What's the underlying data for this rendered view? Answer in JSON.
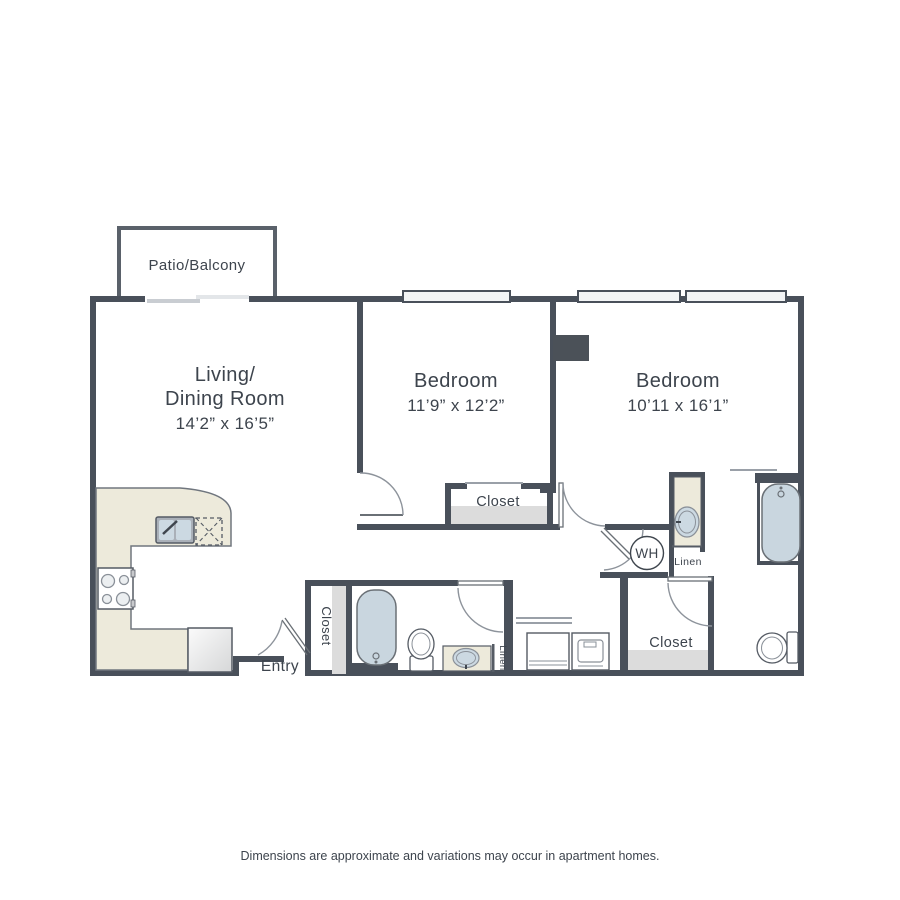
{
  "plan": {
    "patio_label": "Patio/Balcony",
    "living": {
      "name_line1": "Living/",
      "name_line2": "Dining Room",
      "dims": "14’2” x 16’5”"
    },
    "bedroom1": {
      "name": "Bedroom",
      "dims": "11’9” x 12’2”"
    },
    "bedroom2": {
      "name": "Bedroom",
      "dims": "10’11 x 16’1”"
    },
    "closet_bedroom1": "Closet",
    "closet_entry": "Closet",
    "closet_hall": "Closet",
    "linen_bath1": "Linen",
    "linen_bath2": "Linen",
    "water_heater": "WH",
    "entry_label": "Entry"
  },
  "footer": {
    "disclaimer": "Dimensions are approximate and variations may occur in apartment homes."
  },
  "colors": {
    "wall": "#49505a",
    "patio_wall": "#5a616a",
    "counter_beige": "#edeadb",
    "fixture_blue": "#c9d6df",
    "shelf_gray": "#dcdcdc",
    "window_fill": "#f2f4f5",
    "text": "#3d444d"
  }
}
